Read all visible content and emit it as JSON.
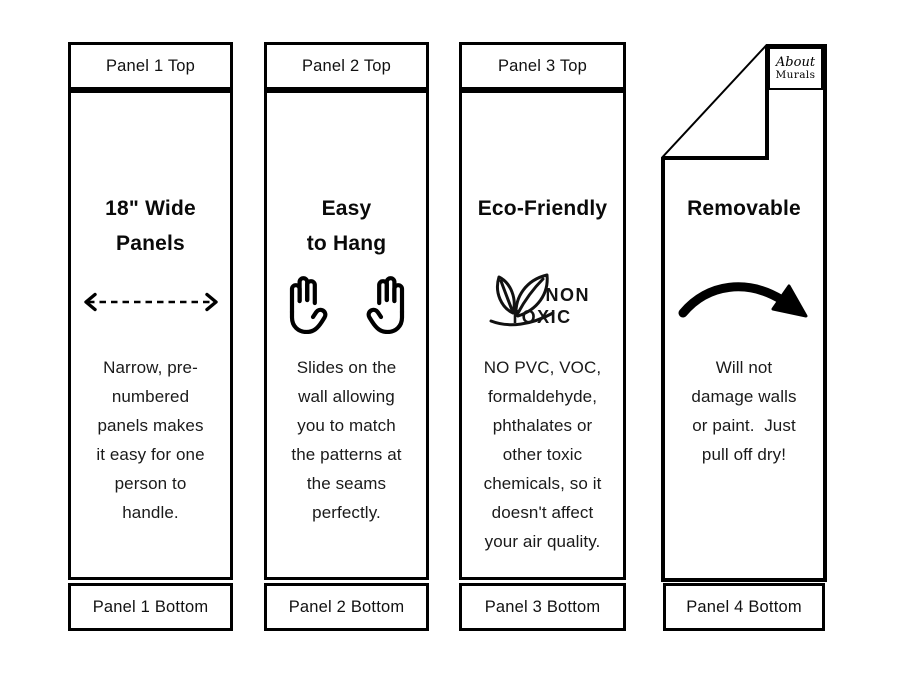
{
  "canvas": {
    "background": "#ffffff",
    "ink": "#000000"
  },
  "brand": {
    "line1": "About",
    "line2": "Murals"
  },
  "panels": [
    {
      "header": "Panel 1 Top",
      "footer": "Panel 1 Bottom",
      "title_lines": [
        "18\" Wide",
        "Panels"
      ],
      "icon": "dashed-width-arrow-icon",
      "body_lines": [
        "Narrow, pre-",
        "numbered",
        "panels makes",
        "it easy for one",
        "person to",
        "handle."
      ]
    },
    {
      "header": "Panel 2 Top",
      "footer": "Panel 2 Bottom",
      "title_lines": [
        "Easy",
        "to Hang"
      ],
      "icon": "two-hands-icon",
      "body_lines": [
        "Slides on the",
        "wall allowing",
        "you to match",
        "the patterns at",
        "the seams",
        "perfectly."
      ]
    },
    {
      "header": "Panel 3 Top",
      "footer": "Panel 3 Bottom",
      "title_lines": [
        "Eco-Friendly"
      ],
      "icon": "non-toxic-leaves-icon",
      "icon_text": {
        "line1": "NON",
        "line2": "TOXIC"
      },
      "body_lines": [
        "NO PVC, VOC,",
        "formaldehyde,",
        "phthalates or",
        "other toxic",
        "chemicals, so it",
        "doesn't affect",
        "your air quality."
      ]
    },
    {
      "footer": "Panel 4 Bottom",
      "title_lines": [
        "Removable"
      ],
      "icon": "curved-arrow-icon",
      "body_lines": [
        "Will not",
        "damage walls",
        "or paint.  Just",
        "pull off dry!"
      ]
    }
  ]
}
